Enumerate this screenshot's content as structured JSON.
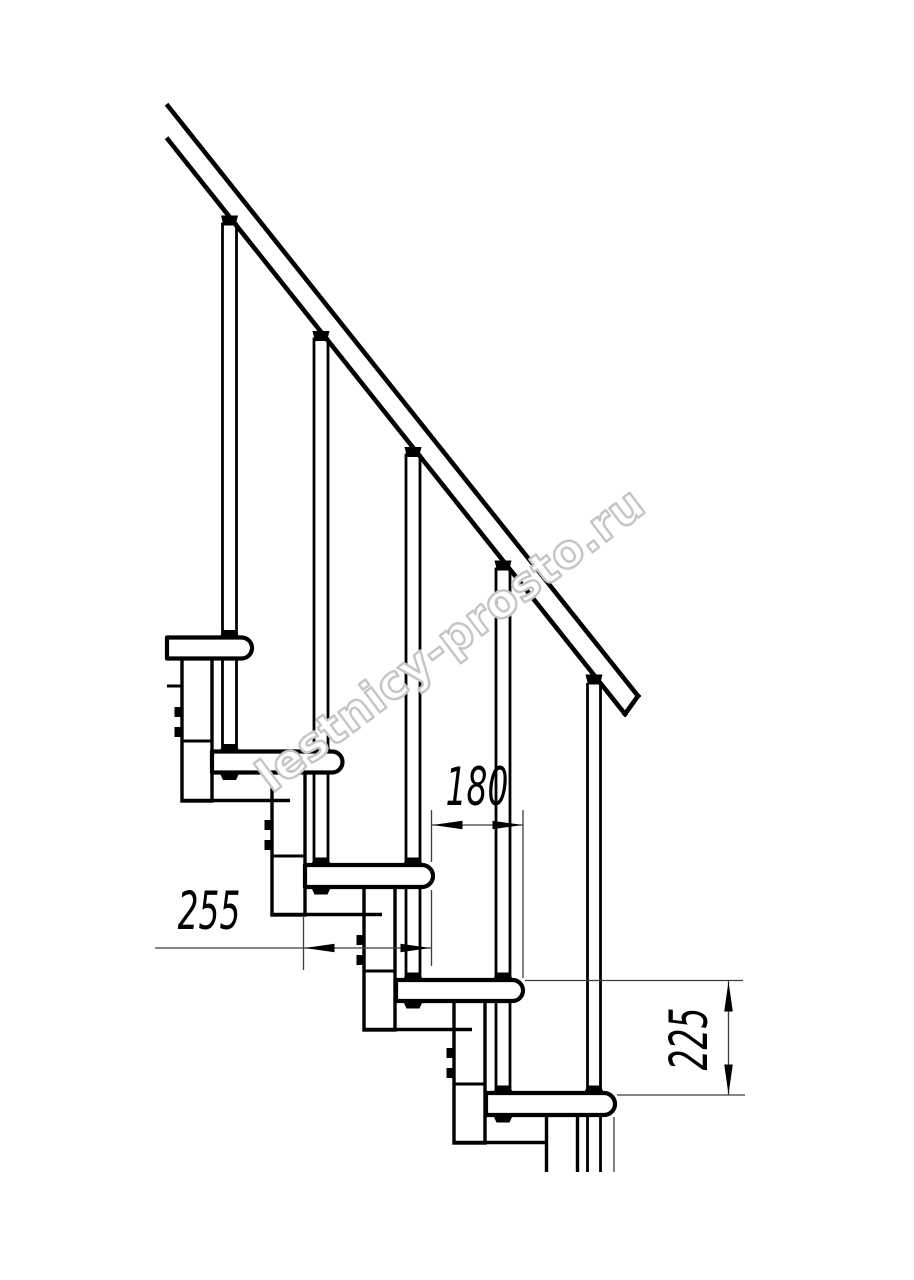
{
  "drawing": {
    "dimensions": {
      "step_run": "180",
      "tread_depth": "255",
      "step_rise": "225"
    },
    "watermark": "lestnicy-prosto.ru",
    "colors": {
      "line": "#000000",
      "thin_line": "#3d3d3d",
      "watermark_outline": "#c5c5c5",
      "background": "#ffffff"
    }
  }
}
